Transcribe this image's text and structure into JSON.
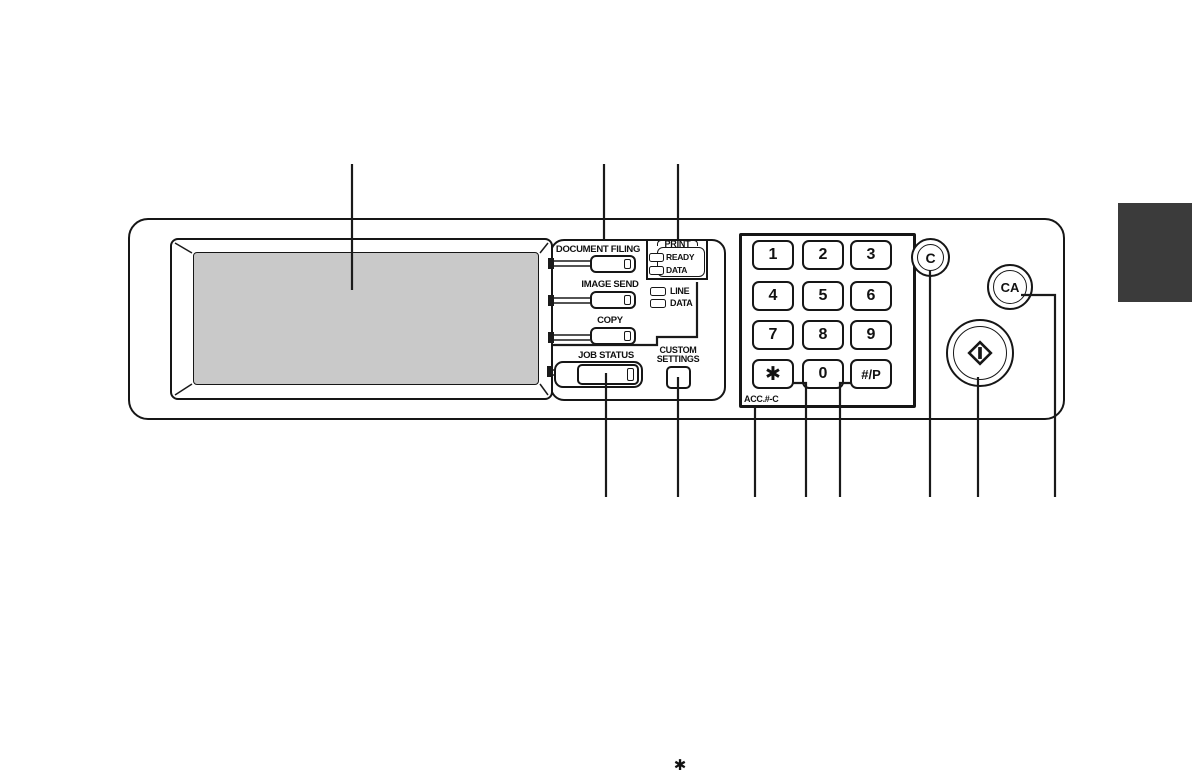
{
  "figure": {
    "kind": "copier operation panel diagram"
  },
  "mode_keys": {
    "document_filing": "DOCUMENT FILING",
    "image_send": "IMAGE SEND",
    "copy": "COPY",
    "job_status": "JOB STATUS"
  },
  "custom_settings": {
    "line1": "CUSTOM",
    "line2": "SETTINGS"
  },
  "print_indicator": {
    "title": "PRINT",
    "ready": "READY",
    "data": "DATA"
  },
  "comm_indicator": {
    "line": "LINE",
    "data": "DATA"
  },
  "keypad": {
    "digits": [
      "1",
      "2",
      "3",
      "4",
      "5",
      "6",
      "7",
      "8",
      "9"
    ],
    "star": "✱",
    "zero": "0",
    "hash": "#/P",
    "acc_label": "ACC.#-C"
  },
  "action_keys": {
    "clear": "C",
    "clear_all": "CA"
  },
  "footnote": {
    "marker": "✱"
  },
  "colors": {
    "screen": "#c9c9c9",
    "tab": "#3b3b3b",
    "line": "#1a1a1a"
  }
}
